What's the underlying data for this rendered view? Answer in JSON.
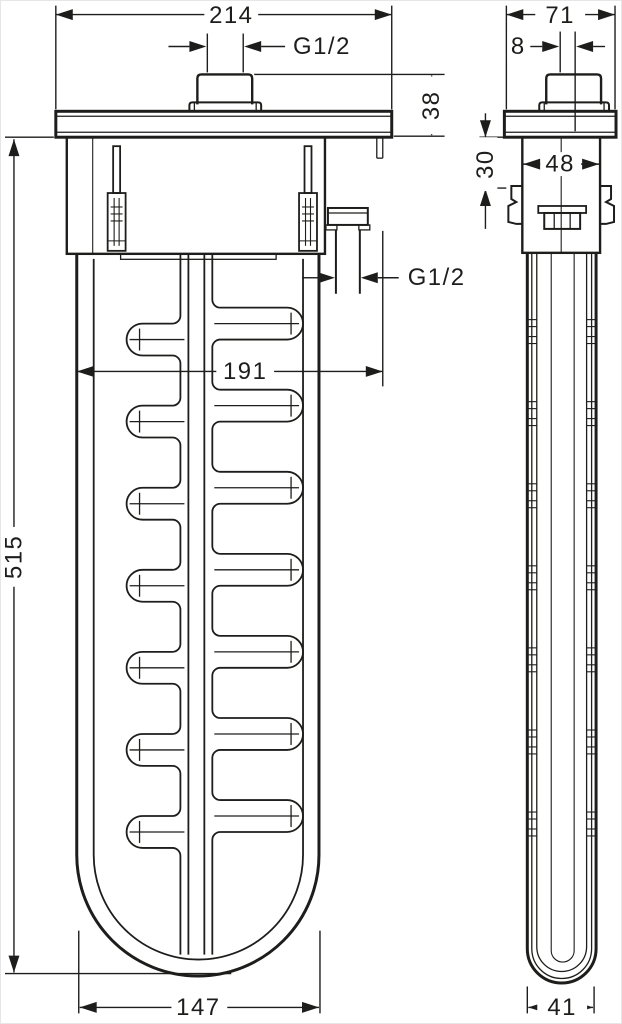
{
  "front_view": {
    "width_top": "214",
    "thread_top": "G1/2",
    "button_height": "38",
    "thread_outlet": "G1/2",
    "inner_width": "191",
    "total_height": "515",
    "body_width": "147"
  },
  "side_view": {
    "width_top": "71",
    "button_offset": "8",
    "collar_height": "30",
    "body_depth": "48",
    "body_width": "41"
  },
  "colors": {
    "line": "#1d1d1b",
    "background": "#ffffff"
  }
}
